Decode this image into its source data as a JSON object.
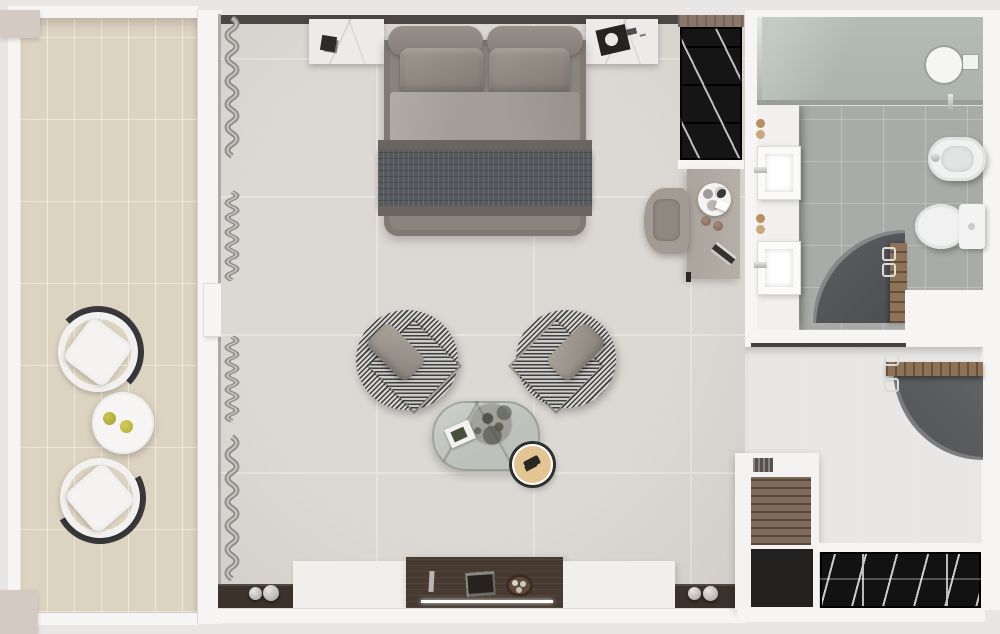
{
  "scene": {
    "title": "Hotel suite floor plan — top-down 3D render",
    "view": "top-down",
    "text_content": "none (image contains no readable text)"
  },
  "rooms": {
    "balcony": {
      "label": "Balcony",
      "floor": "beige ceramic tile",
      "items": [
        "outdoor-chair",
        "outdoor-chair",
        "round-table",
        "lemon",
        "lemon"
      ]
    },
    "bedroom": {
      "label": "Bedroom",
      "floor": "light grey large-format tile",
      "items": [
        "double-bed",
        "headboard-bolsters",
        "pillows",
        "duvet",
        "tweed-throw",
        "nightstand-left",
        "nightstand-right",
        "wardrobe",
        "desk",
        "desk-chair",
        "tray-with-cups",
        "armchair-left",
        "armchair-right",
        "coffee-table",
        "dried-plant",
        "magazine",
        "round-stool",
        "curtains",
        "tv-console",
        "decor-spheres",
        "remote",
        "tray",
        "bowl"
      ]
    },
    "bathroom": {
      "label": "Bathroom",
      "floor": "grey tile",
      "items": [
        "walk-in-shower",
        "rain-shower-head",
        "sink-1",
        "sink-2",
        "toiletries",
        "bidet",
        "toilet",
        "curved-partition",
        "towel-ladder"
      ]
    },
    "entry": {
      "label": "Entry / dressing area",
      "floor": "dark grey tile",
      "items": [
        "curved-partition",
        "towel-shelf",
        "chrome-hooks",
        "shelving-unit",
        "hanging-wardrobe"
      ]
    }
  },
  "palette": {
    "background": "#e9e7e5",
    "walls": "#f6f5f3",
    "bedroom_floor": "#dcd8d4",
    "balcony_floor": "#ddd3c1",
    "bathroom_floor": "#a8aba8",
    "entry_floor_dark": "#6f6f6f",
    "headboard_wall": "#4b4744",
    "bed_grey": "#8a847e",
    "throw_dark": "#565a5f",
    "walnut": "#473b31",
    "wardrobe_black": "#151515",
    "wood": "#8d7257",
    "stool_tan": "#e3c493",
    "lemon_yellow": "#b9b33e",
    "chrome": "#d7dad8"
  }
}
